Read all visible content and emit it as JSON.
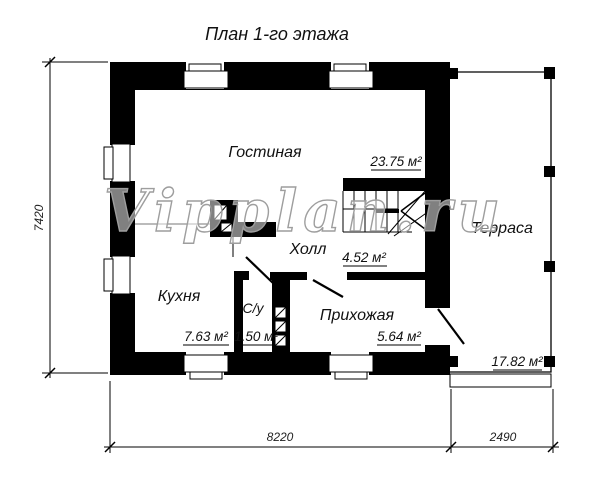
{
  "title": "План 1-го этажа",
  "watermark": "Vipplan.ru",
  "rooms": {
    "living": {
      "name": "Гостиная",
      "area": "23.75 м²"
    },
    "hall": {
      "name": "Холл",
      "area": "4.52 м²"
    },
    "kitchen": {
      "name": "Кухня",
      "area": "7.63 м²"
    },
    "wc": {
      "name": "С/у",
      "area": "1.50 м²"
    },
    "entry": {
      "name": "Прихожая",
      "area": "5.64 м²"
    },
    "terrace": {
      "name": "Терраса",
      "area": "17.82 м²"
    }
  },
  "dimensions": {
    "left_height": "7420",
    "bottom_house_width": "8220",
    "bottom_terrace_width": "2490"
  },
  "colors": {
    "wall": "#000000",
    "line": "#1a1a1a",
    "watermark": "#9e9e9e",
    "background": "#ffffff"
  }
}
